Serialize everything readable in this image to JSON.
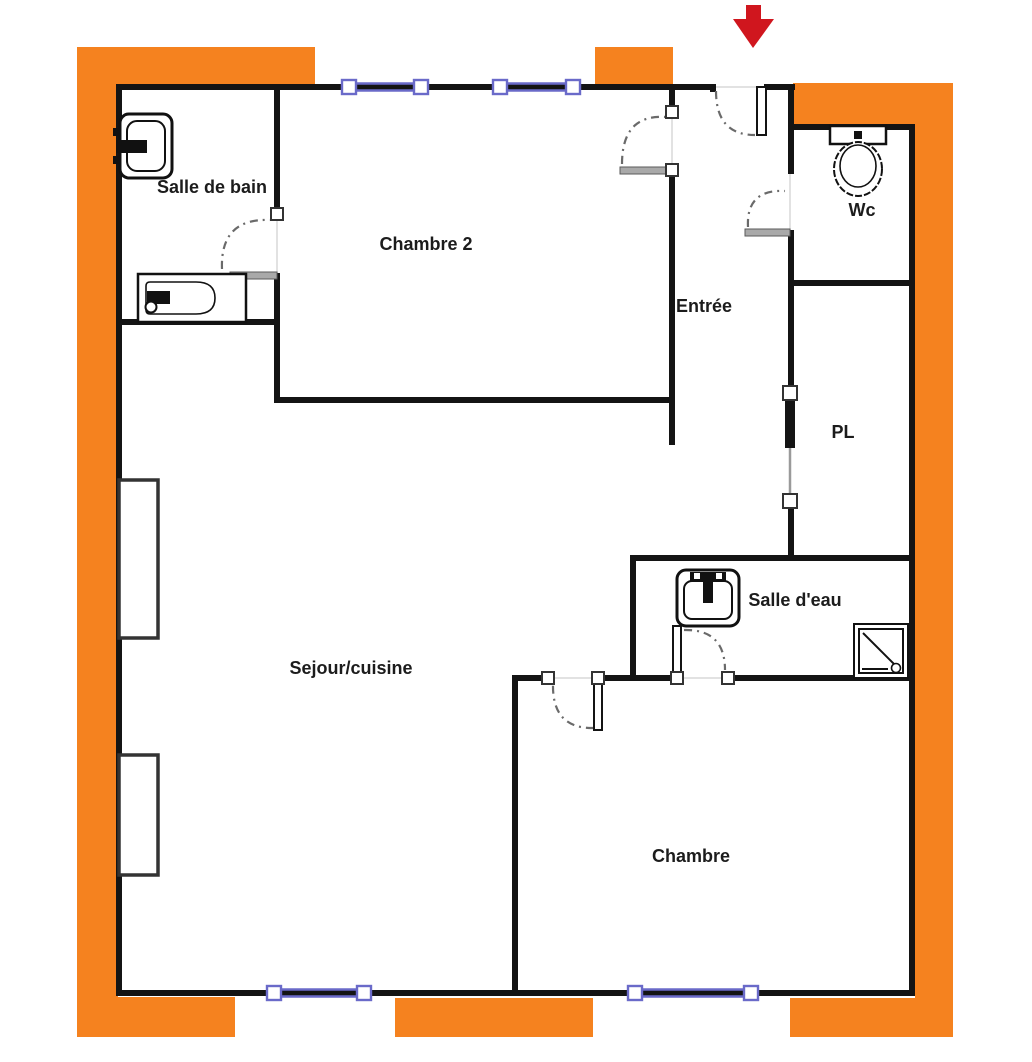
{
  "plan": {
    "type": "apartment-floor-plan",
    "entrance_marker": "red-arrow-down",
    "colors": {
      "insulation_orange": "#F5821F",
      "wall_black": "#141414",
      "window_blue": "#6A6AC9",
      "arrow_red": "#D0161E",
      "door_leaf_gray": "#a9a9a9"
    }
  },
  "rooms": {
    "salle_de_bain": {
      "label": "Salle de bain"
    },
    "chambre2": {
      "label": "Chambre 2"
    },
    "entree": {
      "label": "Entrée"
    },
    "wc": {
      "label": "Wc"
    },
    "pl": {
      "label": "PL"
    },
    "salle_deau": {
      "label": "Salle d'eau"
    },
    "sejour_cuisine": {
      "label": "Sejour/cuisine"
    },
    "chambre": {
      "label": "Chambre"
    }
  },
  "fixtures": {
    "salle_de_bain": [
      "washbasin-icon",
      "bathtub-icon"
    ],
    "wc": [
      "toilet-icon"
    ],
    "salle_deau": [
      "washbasin-icon",
      "shower-tray-icon"
    ],
    "sejour_cuisine": [
      "radiator-icon",
      "radiator-icon"
    ]
  },
  "openings": {
    "windows_count": 4,
    "doors": [
      "entrance-door",
      "chambre2-door",
      "wc-door",
      "salle-de-bain-door",
      "pl-sliding-door",
      "salle-deau-door",
      "chambre-door"
    ]
  }
}
